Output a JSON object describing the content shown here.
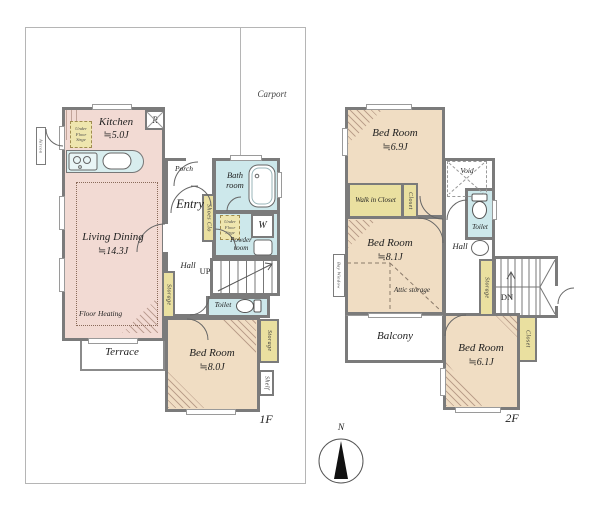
{
  "colors": {
    "wall": "#7b7b7b",
    "room_pink": "#f2dad3",
    "room_tan": "#f0ddc3",
    "room_blue": "#cde8eb",
    "closet_yellow": "#eae0a0",
    "site_line": "#b5b5b5"
  },
  "site": {
    "carport": "Carport",
    "compass_north": "N"
  },
  "floor1": {
    "label": "1F",
    "kitchen": {
      "name": "Kitchen",
      "size": "≒5.0J",
      "fridge": "R",
      "under_floor_storage": "Under Floor Strge"
    },
    "living": {
      "name": "Living Dining",
      "size": "≒14.3J",
      "floor_heating": "Floor Heating"
    },
    "terrace": "Terrace",
    "porch": "Porch",
    "entry": "Entry",
    "shoes_closet": "Shoes Clo",
    "hall": "Hall",
    "stairs_up": "UP",
    "bath": "Bath room",
    "washer": "W",
    "powder": {
      "name": "Powder room",
      "under_floor_storage": "Under Floor Strge"
    },
    "toilet": "Toilet",
    "hall_storage": "Storage",
    "bedroom": {
      "name": "Bed Room",
      "size": "≒8.0J",
      "storage": "Storage",
      "shelf": "Shelf"
    },
    "exterior_unit": "Aircon"
  },
  "floor2": {
    "label": "2F",
    "bedroom1": {
      "name": "Bed Room",
      "size": "≒6.9J",
      "walk_in_closet": "Walk in Closet",
      "closet": "Closet"
    },
    "void": "Void",
    "toilet": "Toilet",
    "hall": "Hall",
    "hall_storage": "Storage",
    "stairs_down": "DN",
    "bedroom2": {
      "name": "Bed Room",
      "size": "≒8.1J",
      "attic": "Attic storage",
      "bay_window": "Bay Window"
    },
    "balcony": "Balcony",
    "bedroom3": {
      "name": "Bed Room",
      "size": "≒6.1J",
      "closet": "Closet"
    }
  }
}
